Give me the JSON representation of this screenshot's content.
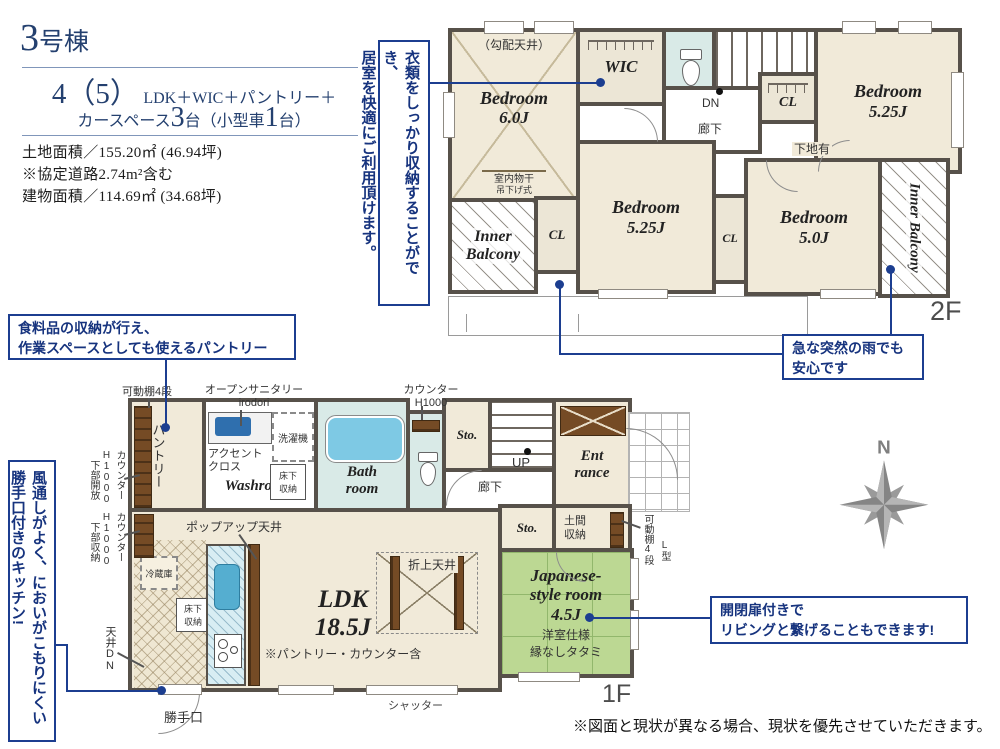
{
  "colors": {
    "accent_navy": "#1c3e90",
    "title_navy": "#24406f",
    "wall": "#57514a",
    "room_beige": "#f1ead9",
    "tatami_green": "#bcd893",
    "water_blue": "#d9eae7",
    "tub_blue": "#7ec9e4",
    "wood_brown": "#754b25",
    "compass_gray": "#8a8a8a"
  },
  "header": {
    "building_num": "3",
    "building_suffix": "号棟",
    "plan_big": "4（5）",
    "plan_rest": "LDK＋WIC＋パントリー＋",
    "plan2_pre": "カースペース",
    "plan2_n1": "3",
    "plan2_mid": "台（小型車",
    "plan2_n2": "1",
    "plan2_post": "台）",
    "land": "土地面積／155.20㎡ (46.94坪)",
    "note": "※協定道路2.74m²含む",
    "building_area": "建物面積／114.69㎡ (34.68坪)"
  },
  "callouts": {
    "wic": {
      "line1": "衣類をしっかり収納することができ、",
      "line2": "居室を快適にご利用頂けます。"
    },
    "pantry": {
      "line1": "食料品の収納が行え、",
      "line2": "作業スペースとしても使えるパントリー"
    },
    "rain": {
      "line1": "急な突然の雨でも",
      "line2": "安心です"
    },
    "kitchen": {
      "line1": "風通しがよく、においがこもりにくい",
      "line2": "勝手口付きのキッチン!"
    },
    "jroom": {
      "line1": "開閉扉付きで",
      "line2": "リビングと繋げることもできます!"
    }
  },
  "f2": {
    "label": "2F",
    "b1_name": "Bedroom",
    "b1_size": "6.0J",
    "b1_note": "（勾配天井）",
    "monohoshi1": "室内物干",
    "monohoshi2": "吊下げ式",
    "wic": "WIC",
    "dn": "DN",
    "hall": "廊下",
    "cl": "CL",
    "b2_name": "Bedroom",
    "b2_size": "5.25J",
    "b3_name": "Bedroom",
    "b3_size": "5.25J",
    "b4_name": "Bedroom",
    "b4_size": "5.0J",
    "shitaji": "下地有",
    "balcony_line1": "Inner",
    "balcony_line2": "Balcony",
    "balcony_r": "Inner Balcony"
  },
  "f1": {
    "label": "1F",
    "pantry": "パントリー",
    "shelf4": "可動棚4段",
    "sanitary1": "オープンサニタリー",
    "sanitary2": "irodori",
    "accent1": "アクセント",
    "accent2": "クロス",
    "washer": "洗濯機",
    "washroom": "Washroom",
    "floor1a": "床下",
    "floor1b": "収納",
    "bath1": "Bath",
    "bath2": "room",
    "counter_top1": "カウンター",
    "counter_top2": "H1000",
    "sto": "Sto.",
    "up": "UP",
    "hall": "廊下",
    "ent1": "Ent",
    "ent2": "rance",
    "doma1": "土間",
    "doma2": "収納",
    "lshelf_main": "可動棚4段",
    "lshelf_sub": "L型",
    "jr1": "Japanese-",
    "jr2": "style room",
    "jr3": "4.5J",
    "jr_note1": "洋室仕様",
    "jr_note2": "縁なしタタミ",
    "ldk1": "LDK",
    "ldk2": "18.5J",
    "ldk_note": "※パントリー・カウンター含",
    "popup": "ポップアップ天井",
    "oriage": "折上天井",
    "fridge": "冷蔵庫",
    "floor2a": "床下",
    "floor2b": "収納",
    "shutter": "シャッター",
    "katte": "勝手口",
    "ceiling_dn": "天井DN",
    "counter_l1a": "カウンター",
    "counter_l1b": "H1000",
    "counter_l1c": "下部開放",
    "counter_l2a": "カウンター",
    "counter_l2b": "H1000",
    "counter_l2c": "下部収納"
  },
  "compass_n": "N",
  "disclaimer": "※図面と現状が異なる場合、現状を優先させていただきます。"
}
